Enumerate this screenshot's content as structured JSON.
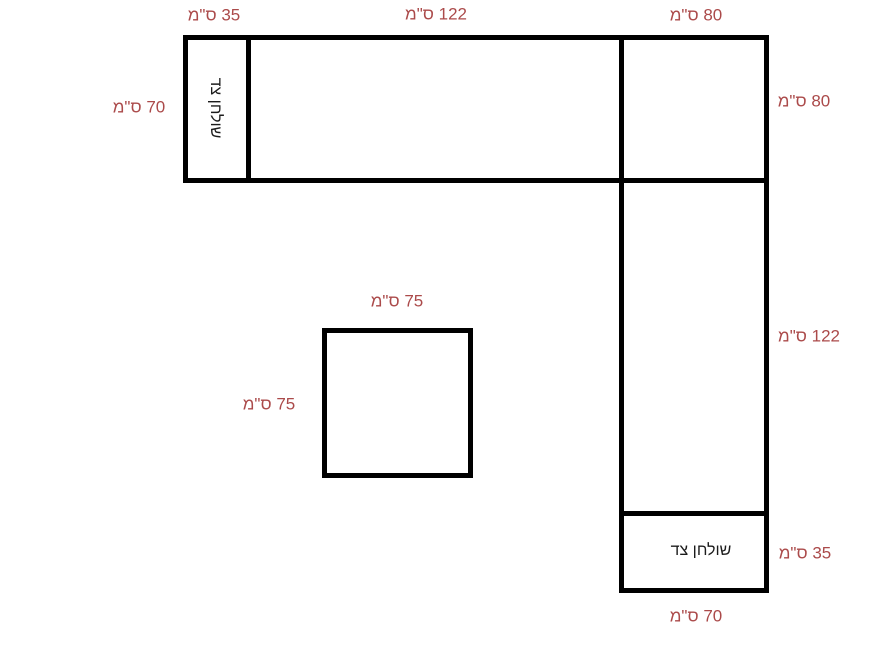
{
  "canvas": {
    "width_px": 891,
    "height_px": 668
  },
  "colors": {
    "background": "#ffffff",
    "outline": "#000000",
    "dimension_text": "#ab4a4a",
    "table_text": "#1c1c1c"
  },
  "tables": {
    "left_side_table_label": "שולחן צד",
    "bottom_side_table_label": "שולחן צד"
  },
  "dimensions": {
    "top_left_width": "35 ס\"מ",
    "top_middle_width": "122 ס\"מ",
    "top_right_width": "80 ס\"מ",
    "left_height": "70 ס\"מ",
    "right_top_height": "80 ס\"מ",
    "right_middle_height": "122 ס\"מ",
    "right_bottom_height": "35 ס\"מ",
    "bottom_width": "70 ס\"מ",
    "square_top_width": "75 ס\"מ",
    "square_left_height": "75 ס\"מ"
  }
}
